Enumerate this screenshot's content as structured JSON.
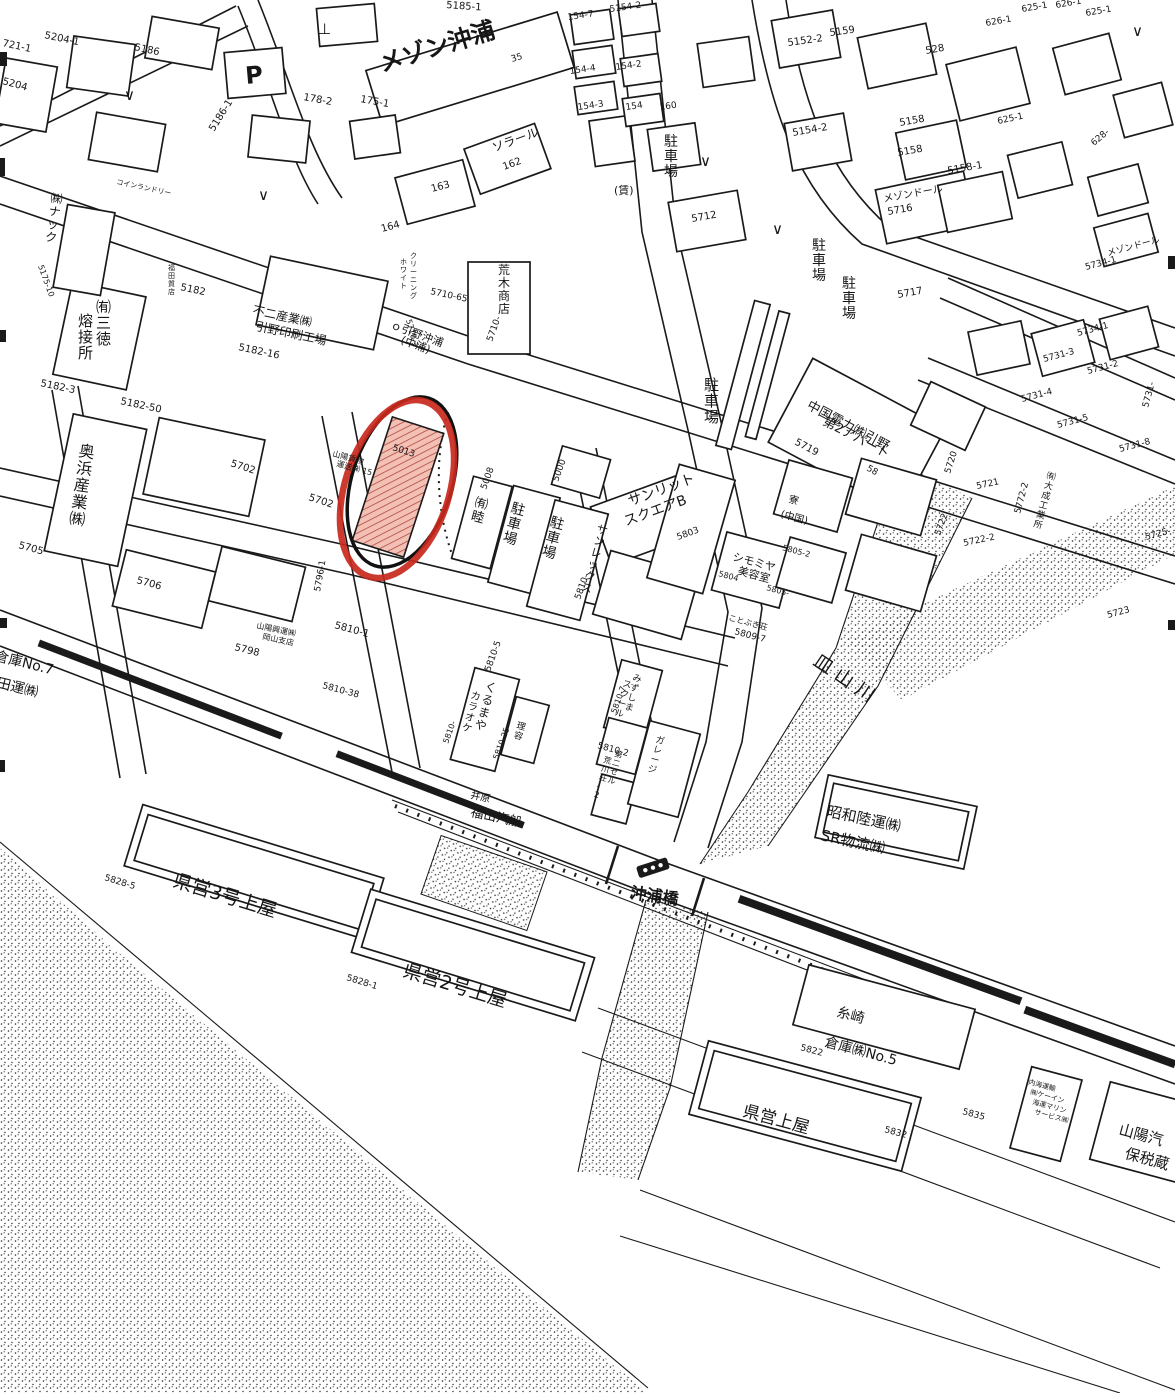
{
  "map": {
    "kind": "scanned-cadastral-map",
    "ink_color": "#1a1a1a",
    "background_color": "#ffffff",
    "annotation": {
      "highlight_color": "#c8281c",
      "outline_color": "#111111",
      "hatch_fill": "#f3c0b6",
      "hatch_line": "#a93a2c",
      "highlighted_parcel": "5013"
    },
    "river_label": "皿山川",
    "bridge_label": "沖浦橋",
    "labels": [
      {
        "t": "721-1",
        "x": 2,
        "y": 46,
        "s": 10,
        "r": 12
      },
      {
        "t": "5204-1",
        "x": 44,
        "y": 38,
        "s": 10,
        "r": 12
      },
      {
        "t": "5204",
        "x": 2,
        "y": 84,
        "s": 10,
        "r": 15
      },
      {
        "t": "5186",
        "x": 134,
        "y": 50,
        "s": 10,
        "r": 12
      },
      {
        "t": "5186-1",
        "x": 214,
        "y": 132,
        "s": 10,
        "r": -58
      },
      {
        "t": "178-2",
        "x": 303,
        "y": 100,
        "s": 10,
        "r": 10
      },
      {
        "t": "175-1",
        "x": 360,
        "y": 102,
        "s": 10,
        "r": 10
      },
      {
        "t": "5185-1",
        "x": 446,
        "y": 8,
        "s": 10,
        "r": 4
      },
      {
        "t": "メゾン沖浦",
        "x": 382,
        "y": 72,
        "s": 24,
        "r": -17,
        "w": true
      },
      {
        "t": "35",
        "x": 512,
        "y": 62,
        "s": 9,
        "r": -17
      },
      {
        "t": "154-7",
        "x": 568,
        "y": 20,
        "s": 9,
        "r": -8
      },
      {
        "t": "5154-2",
        "x": 610,
        "y": 12,
        "s": 9,
        "r": -8
      },
      {
        "t": "154-4",
        "x": 570,
        "y": 74,
        "s": 9,
        "r": -8
      },
      {
        "t": "154-2",
        "x": 616,
        "y": 70,
        "s": 9,
        "r": -8
      },
      {
        "t": "154-3",
        "x": 578,
        "y": 110,
        "s": 9,
        "r": -8
      },
      {
        "t": "154",
        "x": 626,
        "y": 110,
        "s": 9,
        "r": -8
      },
      {
        "t": "160",
        "x": 660,
        "y": 110,
        "s": 9,
        "r": -8
      },
      {
        "t": "5152-2",
        "x": 788,
        "y": 46,
        "s": 10,
        "r": -8
      },
      {
        "t": "5159",
        "x": 830,
        "y": 36,
        "s": 10,
        "r": -8
      },
      {
        "t": "528",
        "x": 926,
        "y": 54,
        "s": 10,
        "r": -10
      },
      {
        "t": "626-1",
        "x": 986,
        "y": 26,
        "s": 9,
        "r": -10
      },
      {
        "t": "625-1",
        "x": 1022,
        "y": 12,
        "s": 9,
        "r": -10
      },
      {
        "t": "626-1",
        "x": 1056,
        "y": 8,
        "s": 9,
        "r": -10
      },
      {
        "t": "625-1",
        "x": 1086,
        "y": 16,
        "s": 9,
        "r": -10
      },
      {
        "t": "625-1",
        "x": 998,
        "y": 124,
        "s": 9,
        "r": -12
      },
      {
        "t": "628-",
        "x": 1094,
        "y": 146,
        "s": 9,
        "r": -40
      },
      {
        "t": "ソラール",
        "x": 494,
        "y": 152,
        "s": 12,
        "r": -20
      },
      {
        "t": "162",
        "x": 504,
        "y": 170,
        "s": 10,
        "r": -20
      },
      {
        "t": "163",
        "x": 432,
        "y": 192,
        "s": 10,
        "r": -15
      },
      {
        "t": "164",
        "x": 382,
        "y": 232,
        "s": 10,
        "r": -15
      },
      {
        "t": "(賃)",
        "x": 614,
        "y": 194,
        "s": 11
      },
      {
        "t": "5712",
        "x": 692,
        "y": 222,
        "s": 10,
        "r": -10
      },
      {
        "t": "5154-2",
        "x": 793,
        "y": 136,
        "s": 10,
        "r": -10
      },
      {
        "t": "5158",
        "x": 900,
        "y": 126,
        "s": 10,
        "r": -10
      },
      {
        "t": "5158",
        "x": 898,
        "y": 156,
        "s": 10,
        "r": -10
      },
      {
        "t": "5158-1",
        "x": 948,
        "y": 174,
        "s": 10,
        "r": -10
      },
      {
        "t": "メゾンドール",
        "x": 884,
        "y": 202,
        "s": 10,
        "r": -10
      },
      {
        "t": "5716",
        "x": 888,
        "y": 215,
        "s": 10,
        "r": -10
      },
      {
        "t": "メゾンドール",
        "x": 1108,
        "y": 256,
        "s": 9,
        "r": -15
      },
      {
        "t": "5734-1",
        "x": 1086,
        "y": 270,
        "s": 9,
        "r": -15
      },
      {
        "t": "5734-1",
        "x": 1078,
        "y": 336,
        "s": 9,
        "r": -15
      },
      {
        "t": "5731-3",
        "x": 1044,
        "y": 362,
        "s": 9,
        "r": -15
      },
      {
        "t": "5731-2",
        "x": 1088,
        "y": 374,
        "s": 9,
        "r": -15
      },
      {
        "t": "5731-4",
        "x": 1022,
        "y": 402,
        "s": 9,
        "r": -15
      },
      {
        "t": "5731-5",
        "x": 1058,
        "y": 428,
        "s": 9,
        "r": -15
      },
      {
        "t": "5731-8",
        "x": 1120,
        "y": 452,
        "s": 9,
        "r": -15
      },
      {
        "t": "5731-",
        "x": 1148,
        "y": 408,
        "s": 9,
        "r": -75
      },
      {
        "t": "5725-",
        "x": 1146,
        "y": 540,
        "s": 9,
        "r": -15
      },
      {
        "t": "5723",
        "x": 1108,
        "y": 618,
        "s": 9,
        "r": -15
      },
      {
        "t": "5717",
        "x": 898,
        "y": 298,
        "s": 10,
        "r": -10
      },
      {
        "t": "中国電力㈱引野",
        "x": 806,
        "y": 408,
        "s": 13,
        "r": 28
      },
      {
        "t": "第2アパート",
        "x": 822,
        "y": 424,
        "s": 13,
        "r": 28
      },
      {
        "t": "5719",
        "x": 794,
        "y": 444,
        "s": 10,
        "r": 28
      },
      {
        "t": "58",
        "x": 866,
        "y": 470,
        "s": 9,
        "r": 28
      },
      {
        "t": "5720",
        "x": 950,
        "y": 474,
        "s": 9,
        "r": -72
      },
      {
        "t": "5721",
        "x": 977,
        "y": 489,
        "s": 9,
        "r": -12
      },
      {
        "t": "5722",
        "x": 940,
        "y": 536,
        "s": 9,
        "r": -70
      },
      {
        "t": "5722-2",
        "x": 964,
        "y": 546,
        "s": 9,
        "r": -12
      },
      {
        "t": "5772-2",
        "x": 1020,
        "y": 514,
        "s": 9,
        "r": -75
      },
      {
        "t": "不二産業㈱",
        "x": 252,
        "y": 314,
        "s": 12,
        "r": 12
      },
      {
        "t": "引野印刷工場",
        "x": 255,
        "y": 330,
        "s": 12,
        "r": 12
      },
      {
        "t": "5182-16",
        "x": 238,
        "y": 350,
        "s": 10,
        "r": 12
      },
      {
        "t": "5182",
        "x": 180,
        "y": 290,
        "s": 10,
        "r": 12
      },
      {
        "t": "5182-3",
        "x": 40,
        "y": 386,
        "s": 10,
        "r": 12
      },
      {
        "t": "5182-50",
        "x": 120,
        "y": 404,
        "s": 10,
        "r": 12
      },
      {
        "t": "5705",
        "x": 18,
        "y": 548,
        "s": 10,
        "r": 15
      },
      {
        "t": "5706",
        "x": 136,
        "y": 583,
        "s": 10,
        "r": 15
      },
      {
        "t": "5702",
        "x": 230,
        "y": 466,
        "s": 10,
        "r": 18
      },
      {
        "t": "5702",
        "x": 308,
        "y": 500,
        "s": 10,
        "r": 18
      },
      {
        "t": "5798",
        "x": 234,
        "y": 650,
        "s": 10,
        "r": 14
      },
      {
        "t": "山陽興運㈱",
        "x": 256,
        "y": 628,
        "s": 8,
        "r": 12
      },
      {
        "t": "岡山支店",
        "x": 262,
        "y": 639,
        "s": 8,
        "r": 12
      },
      {
        "t": "5796-1",
        "x": 320,
        "y": 592,
        "s": 9,
        "r": -80
      },
      {
        "t": "倉庫No.7",
        "x": -6,
        "y": 660,
        "s": 14,
        "r": 14
      },
      {
        "t": "田運㈱",
        "x": -4,
        "y": 687,
        "s": 14,
        "r": 14
      },
      {
        "t": "ｏ引野沖浦",
        "x": 390,
        "y": 328,
        "s": 11,
        "r": 20
      },
      {
        "t": "(中浦)",
        "x": 400,
        "y": 343,
        "s": 11,
        "r": 20
      },
      {
        "t": "5710-",
        "x": 492,
        "y": 342,
        "s": 9,
        "r": -70
      },
      {
        "t": "5710-65",
        "x": 430,
        "y": 294,
        "s": 9,
        "r": 12
      },
      {
        "t": "5710-3",
        "x": 406,
        "y": 320,
        "s": 8,
        "r": 75
      },
      {
        "t": "5013",
        "x": 392,
        "y": 450,
        "s": 9,
        "r": 18
      },
      {
        "t": "山陽貨物",
        "x": 332,
        "y": 456,
        "s": 8,
        "r": 15
      },
      {
        "t": "運送㈱ 15",
        "x": 336,
        "y": 466,
        "s": 8,
        "r": 15
      },
      {
        "t": "5008",
        "x": 486,
        "y": 490,
        "s": 9,
        "r": -70
      },
      {
        "t": "5000",
        "x": 558,
        "y": 482,
        "s": 9,
        "r": -70
      },
      {
        "t": "5810-",
        "x": 580,
        "y": 600,
        "s": 9,
        "r": -70
      },
      {
        "t": "サンリット",
        "x": 630,
        "y": 506,
        "s": 14,
        "r": -20
      },
      {
        "t": "スクエアB",
        "x": 626,
        "y": 526,
        "s": 14,
        "r": -20
      },
      {
        "t": "5803",
        "x": 678,
        "y": 540,
        "s": 9,
        "r": -20
      },
      {
        "t": "寮",
        "x": 788,
        "y": 502,
        "s": 10,
        "r": 15
      },
      {
        "t": "(中国)",
        "x": 780,
        "y": 517,
        "s": 10,
        "r": 15
      },
      {
        "t": "シモミヤ",
        "x": 732,
        "y": 560,
        "s": 11,
        "r": 15
      },
      {
        "t": "美容室",
        "x": 737,
        "y": 574,
        "s": 11,
        "r": 15
      },
      {
        "t": "5804",
        "x": 718,
        "y": 576,
        "s": 8,
        "r": 15
      },
      {
        "t": "5805-2",
        "x": 782,
        "y": 550,
        "s": 8,
        "r": 15
      },
      {
        "t": "5805-",
        "x": 766,
        "y": 590,
        "s": 8,
        "r": 15
      },
      {
        "t": "ことぶき荘",
        "x": 728,
        "y": 620,
        "s": 8,
        "r": 15
      },
      {
        "t": "5809-7",
        "x": 734,
        "y": 634,
        "s": 9,
        "r": 15
      },
      {
        "t": "5810-1",
        "x": 334,
        "y": 628,
        "s": 10,
        "r": 15
      },
      {
        "t": "5810-38",
        "x": 322,
        "y": 688,
        "s": 9,
        "r": 15
      },
      {
        "t": "5810-5",
        "x": 490,
        "y": 672,
        "s": 9,
        "r": -70
      },
      {
        "t": "5810-",
        "x": 448,
        "y": 744,
        "s": 8,
        "r": -70
      },
      {
        "t": "5810-25",
        "x": 498,
        "y": 760,
        "s": 8,
        "r": -70
      },
      {
        "t": "5810-7",
        "x": 616,
        "y": 714,
        "s": 8,
        "r": -70
      },
      {
        "t": "5810-2",
        "x": 597,
        "y": 748,
        "s": 9,
        "r": 15
      },
      {
        "t": "井原",
        "x": 470,
        "y": 798,
        "s": 10,
        "r": 12
      },
      {
        "t": "福山汽船",
        "x": 470,
        "y": 816,
        "s": 13,
        "r": 12
      },
      {
        "t": "沖浦橋",
        "x": 630,
        "y": 898,
        "s": 16,
        "r": 8,
        "w": true
      },
      {
        "t": "皿山川",
        "x": 812,
        "y": 664,
        "s": 19,
        "r": 34,
        "ls": 6
      },
      {
        "t": "昭和陸運㈱",
        "x": 826,
        "y": 816,
        "s": 15,
        "r": 12
      },
      {
        "t": "SR物流㈱",
        "x": 820,
        "y": 840,
        "s": 15,
        "r": 12
      },
      {
        "t": "県営3号上屋",
        "x": 172,
        "y": 886,
        "s": 19,
        "r": 17
      },
      {
        "t": "5828-5",
        "x": 104,
        "y": 880,
        "s": 9,
        "r": 17
      },
      {
        "t": "県営2号上屋",
        "x": 402,
        "y": 976,
        "s": 19,
        "r": 17
      },
      {
        "t": "5828-1",
        "x": 346,
        "y": 980,
        "s": 9,
        "r": 17
      },
      {
        "t": "糸崎",
        "x": 836,
        "y": 1016,
        "s": 14,
        "r": 15
      },
      {
        "t": "倉庫㈱No.5",
        "x": 824,
        "y": 1046,
        "s": 14,
        "r": 15
      },
      {
        "t": "5822",
        "x": 800,
        "y": 1050,
        "s": 9,
        "r": 15
      },
      {
        "t": "県営上屋",
        "x": 742,
        "y": 1116,
        "s": 17,
        "r": 15
      },
      {
        "t": "5832",
        "x": 884,
        "y": 1132,
        "s": 9,
        "r": 15
      },
      {
        "t": "5835",
        "x": 962,
        "y": 1114,
        "s": 9,
        "r": 15
      },
      {
        "t": "内海運輸",
        "x": 1028,
        "y": 1084,
        "s": 7,
        "r": 15
      },
      {
        "t": "㈱ケーイン",
        "x": 1030,
        "y": 1094,
        "s": 7,
        "r": 15
      },
      {
        "t": "海運マリン",
        "x": 1032,
        "y": 1104,
        "s": 7,
        "r": 15
      },
      {
        "t": "サービス㈱",
        "x": 1034,
        "y": 1114,
        "s": 7,
        "r": 15
      },
      {
        "t": "山陽汽",
        "x": 1118,
        "y": 1134,
        "s": 15,
        "r": 15
      },
      {
        "t": "保税蔵",
        "x": 1124,
        "y": 1158,
        "s": 15,
        "r": 15
      },
      {
        "t": "5175-10",
        "x": 38,
        "y": 266,
        "s": 8,
        "r": 70
      },
      {
        "t": "コインランドリー",
        "x": 116,
        "y": 184,
        "s": 7,
        "r": 12
      },
      {
        "t": "P",
        "x": 246,
        "y": 84,
        "s": 24,
        "r": -5,
        "w": true,
        "n": "parking-icon"
      },
      {
        "t": "∨",
        "x": 124,
        "y": 100,
        "s": 15,
        "n": "check-mark-icon"
      },
      {
        "t": "∨",
        "x": 258,
        "y": 200,
        "s": 15,
        "n": "check-mark-icon"
      },
      {
        "t": "∨",
        "x": 700,
        "y": 166,
        "s": 15,
        "n": "check-mark-icon"
      },
      {
        "t": "∨",
        "x": 772,
        "y": 234,
        "s": 15,
        "n": "check-mark-icon"
      },
      {
        "t": "∨",
        "x": 1132,
        "y": 36,
        "s": 15,
        "n": "check-mark-icon"
      },
      {
        "t": "⊥",
        "x": 318,
        "y": 34,
        "s": 15,
        "n": "survey-mark-icon"
      },
      {
        "t": "㈲三徳",
        "x": 96,
        "y": 312,
        "s": 15,
        "v": true
      },
      {
        "t": "熔接所",
        "x": 78,
        "y": 326,
        "s": 15,
        "v": true
      },
      {
        "t": "奥浜産業㈱",
        "x": 78,
        "y": 456,
        "s": 16,
        "v": true,
        "r": 8
      },
      {
        "t": "㈱ナック",
        "x": 50,
        "y": 202,
        "s": 12,
        "v": true,
        "r": 8
      },
      {
        "t": "福田質店",
        "x": 168,
        "y": 270,
        "s": 7,
        "v": true
      },
      {
        "t": "駐車場",
        "x": 664,
        "y": 146,
        "s": 14,
        "v": true
      },
      {
        "t": "駐車場",
        "x": 812,
        "y": 250,
        "s": 14,
        "v": true
      },
      {
        "t": "駐車場",
        "x": 842,
        "y": 288,
        "s": 14,
        "v": true
      },
      {
        "t": "駐車場",
        "x": 704,
        "y": 390,
        "s": 15,
        "v": true
      },
      {
        "t": "駐車場",
        "x": 510,
        "y": 512,
        "s": 14,
        "v": true,
        "r": 15
      },
      {
        "t": "駐車場",
        "x": 549,
        "y": 526,
        "s": 14,
        "v": true,
        "r": 15
      },
      {
        "t": "㈲睦",
        "x": 474,
        "y": 506,
        "s": 13,
        "v": true,
        "r": 15
      },
      {
        "t": "サンレックス",
        "x": 596,
        "y": 532,
        "s": 11,
        "v": true,
        "r": 15
      },
      {
        "t": "荒木商店",
        "x": 498,
        "y": 274,
        "s": 12,
        "v": true
      },
      {
        "t": "ホワイト",
        "x": 400,
        "y": 264,
        "s": 7,
        "v": true
      },
      {
        "t": "クリーニング",
        "x": 410,
        "y": 258,
        "s": 7,
        "v": true
      },
      {
        "t": "くるまや",
        "x": 484,
        "y": 690,
        "s": 12,
        "v": true,
        "r": 15
      },
      {
        "t": "カラオケ",
        "x": 470,
        "y": 698,
        "s": 10,
        "v": true,
        "r": 15
      },
      {
        "t": "理容",
        "x": 516,
        "y": 728,
        "s": 9,
        "v": true,
        "r": 15
      },
      {
        "t": "みずしま",
        "x": 632,
        "y": 680,
        "s": 9,
        "v": true,
        "r": 15
      },
      {
        "t": "スクール",
        "x": 622,
        "y": 686,
        "s": 9,
        "v": true,
        "r": 15
      },
      {
        "t": "第二セル",
        "x": 614,
        "y": 756,
        "s": 8,
        "v": true,
        "r": 15
      },
      {
        "t": "荒川荘-2",
        "x": 603,
        "y": 762,
        "s": 8,
        "v": true,
        "r": 15
      },
      {
        "t": "ガレージ",
        "x": 655,
        "y": 742,
        "s": 9,
        "v": true,
        "r": 15
      },
      {
        "t": "㈲大成工業所",
        "x": 1046,
        "y": 478,
        "s": 9,
        "v": true,
        "r": 15
      }
    ]
  }
}
